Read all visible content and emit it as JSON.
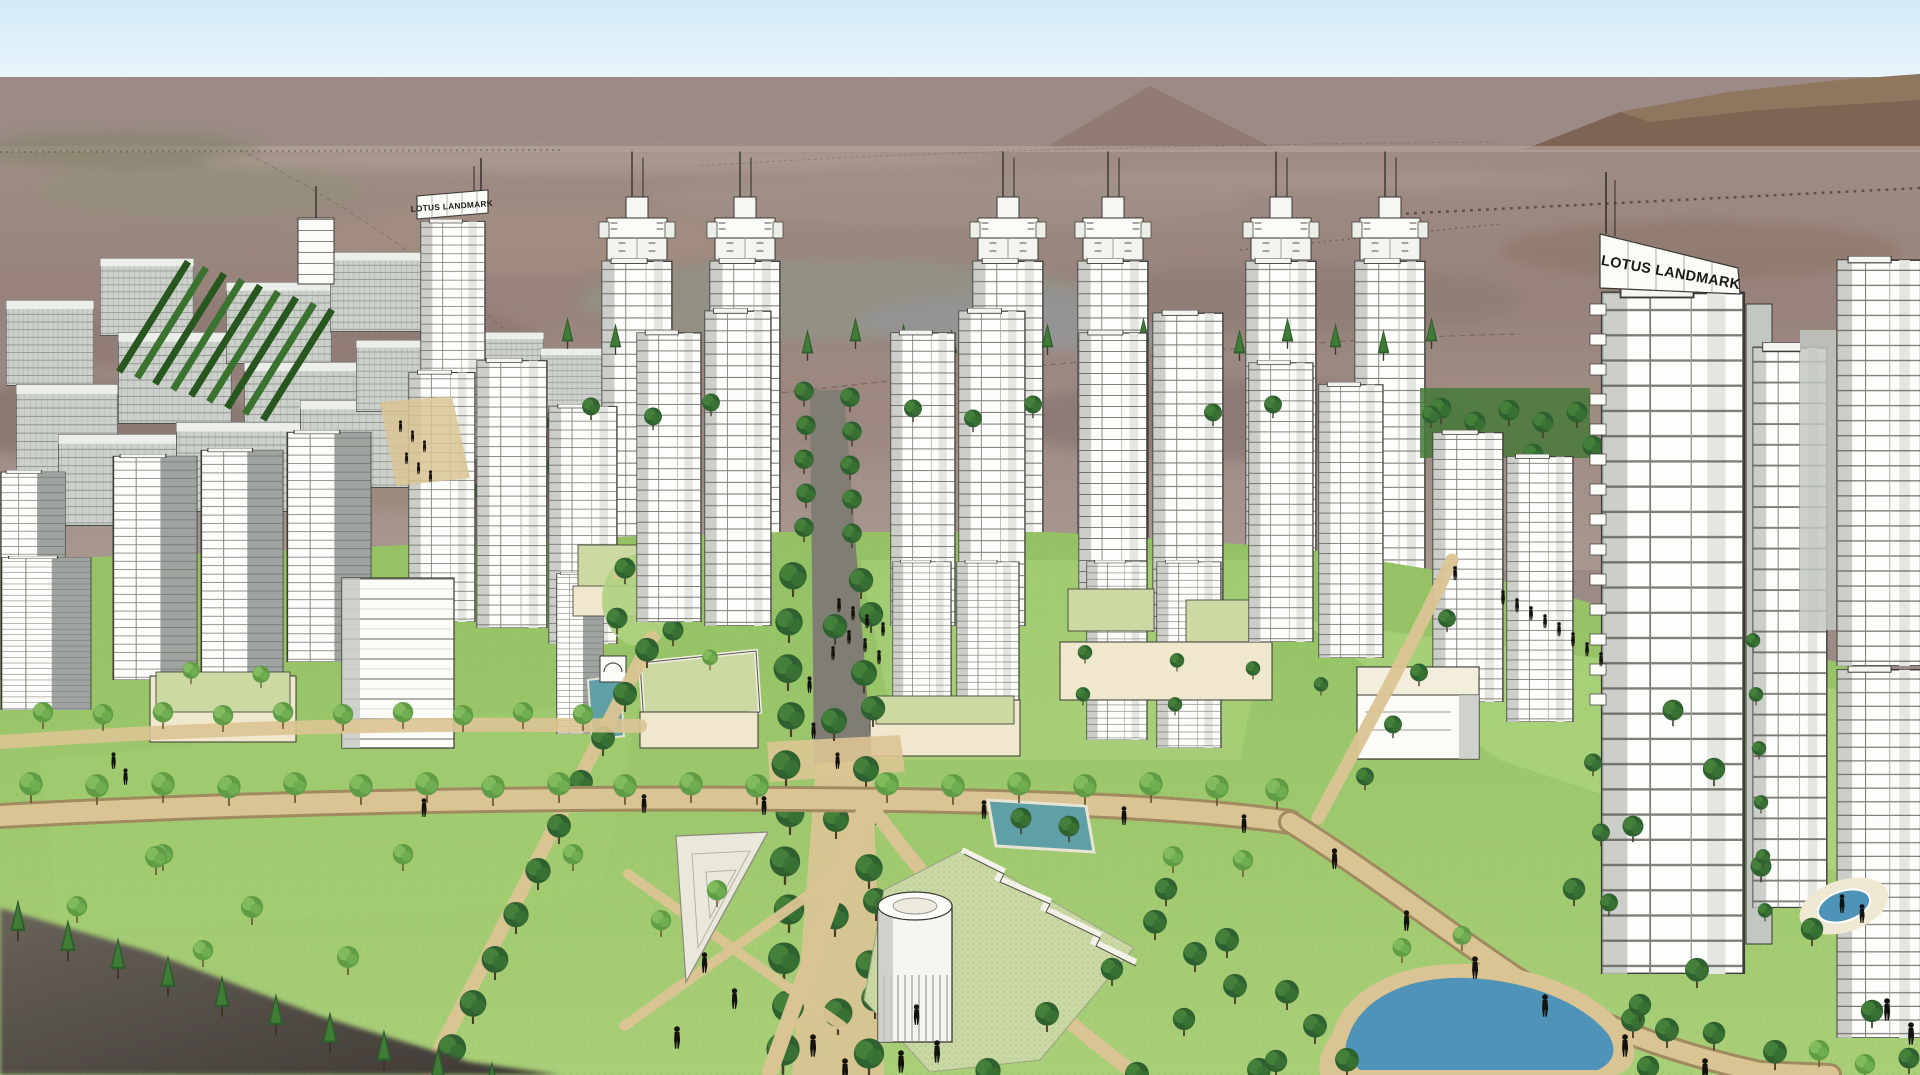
{
  "scene": {
    "title": "Lotus Landmark residential master plan — aerial rendering",
    "signs": {
      "left": "LOTUS LANDMARK",
      "right": "LOTUS LANDMARK"
    },
    "palette": {
      "sky": "#d3eaf7",
      "skyLow": "#e9f5fb",
      "horizon": "#9b8a85",
      "mountain": "#7e6553",
      "mountainLight": "#977d64",
      "desert": "#9a867d",
      "desertLight": "#ab9a90",
      "desertDark": "#84716b",
      "white": "#fbfbf8",
      "shade": "#c3c7c1",
      "shadeDark": "#9fa4a1",
      "outline": "#3a3833",
      "lawn": "#8cbb5e",
      "lawnLight": "#aed27f",
      "lawnPale": "#c9d8a4",
      "treeDark": "#2f6130",
      "treeMid": "#44803a",
      "treeLight": "#82bb5e",
      "path": "#dbc494",
      "pathDark": "#a08a60",
      "roofGreen": "#ccd9a2",
      "cream": "#efe8cd",
      "water": "#4f93b8",
      "pool": "#5fa0a6",
      "figure": "#14120f",
      "darkSlope": "#47423c"
    }
  }
}
